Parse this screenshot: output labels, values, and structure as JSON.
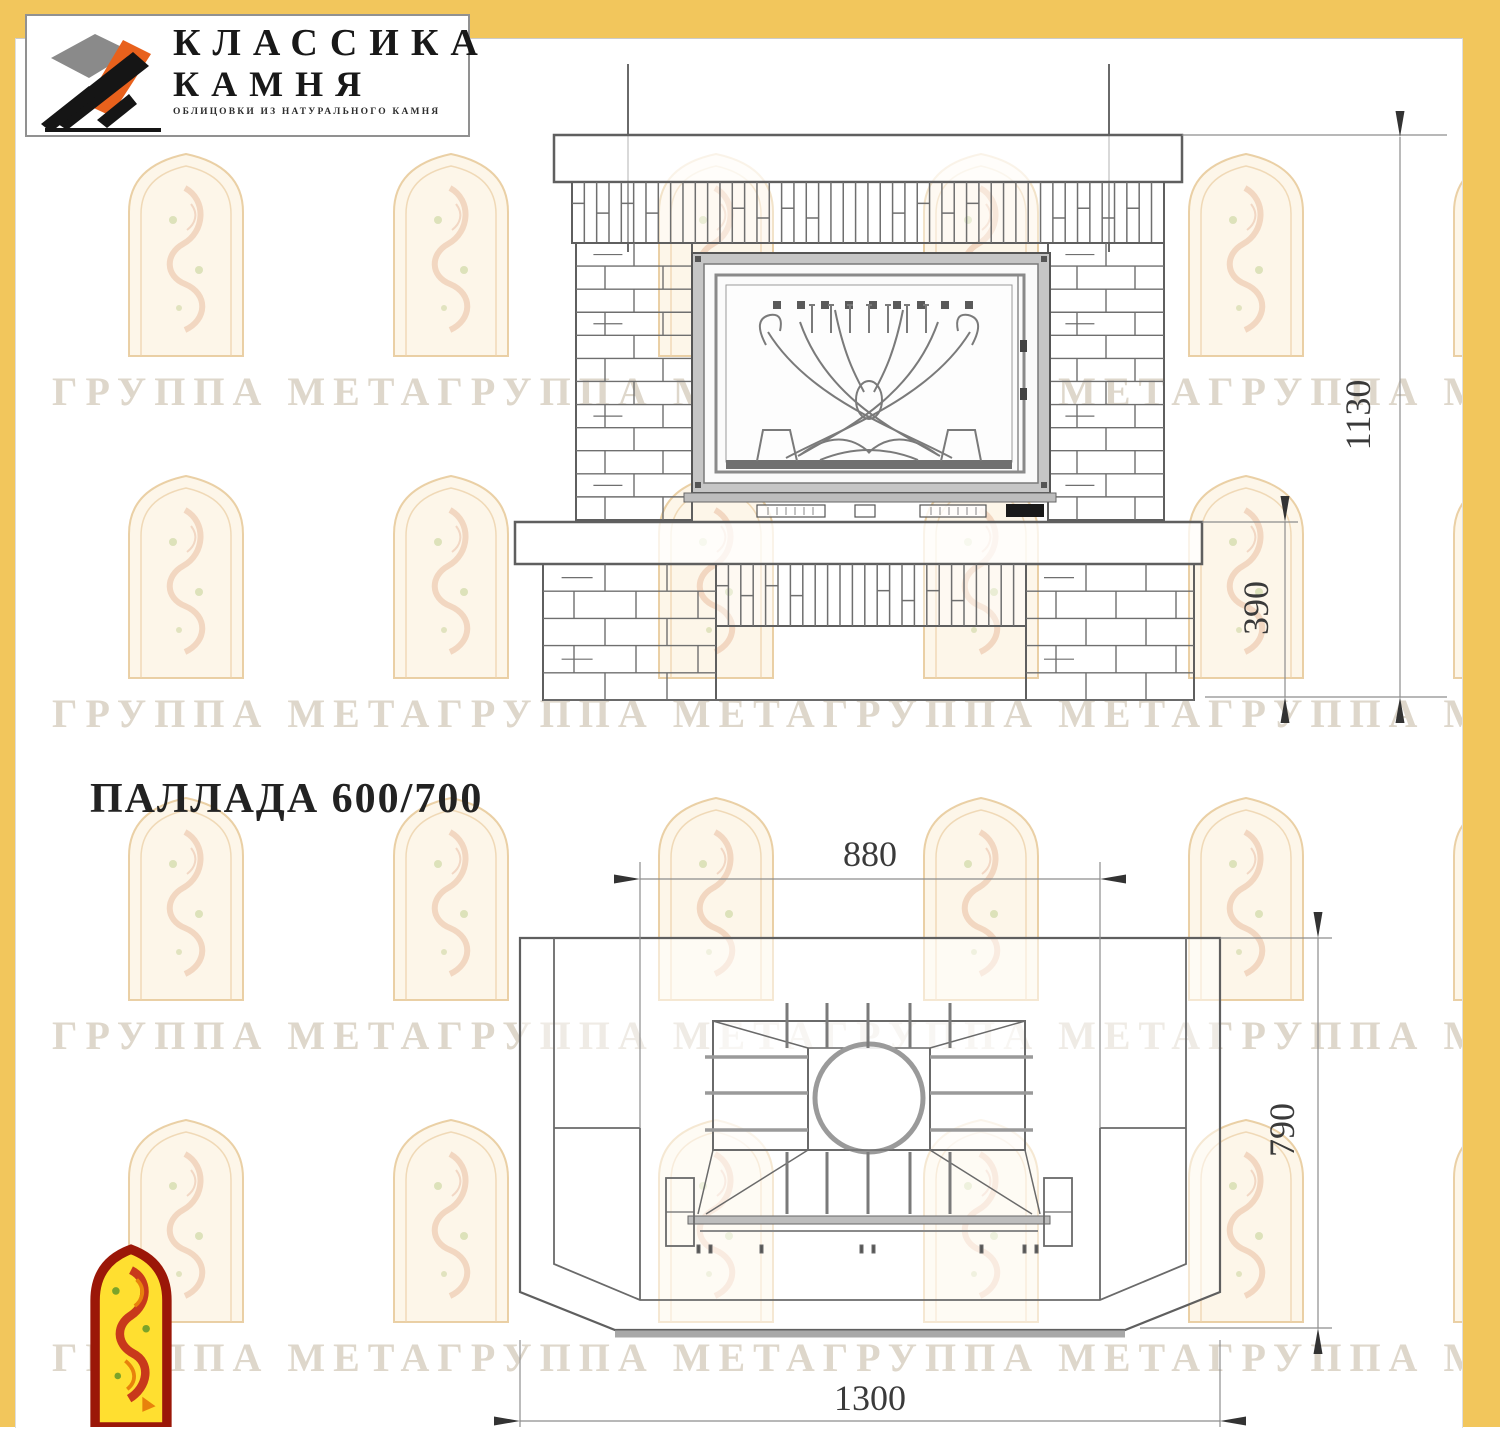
{
  "brand": {
    "title_line1": "КЛАССИКА",
    "title_line2": "КАМНЯ",
    "tagline": "ОБЛИЦОВКИ ИЗ НАТУРАЛЬНОГО КАМНЯ"
  },
  "product": {
    "title": "ПАЛЛАДА 600/700"
  },
  "watermark": {
    "row_text": "ГРУППА МЕТАГРУППА МЕТАГРУППА МЕТАГРУППА МЕТА"
  },
  "front_view": {
    "dim_total_height": "1130",
    "dim_hearth_height": "390"
  },
  "plan_view": {
    "dim_firebox_width": "880",
    "dim_depth": "790",
    "dim_total_width": "1300"
  },
  "colors": {
    "frame_yellow": "#f2c65c",
    "drawing_line": "#606060",
    "dim_text": "#3a3a3a",
    "logo_orange": "#e8611c",
    "logo_grey": "#8a8a8a",
    "logo_black": "#151515",
    "badge_yellow": "#ffdf30",
    "badge_red": "#9b1708",
    "watermark_tan": "#e8cb9c"
  }
}
